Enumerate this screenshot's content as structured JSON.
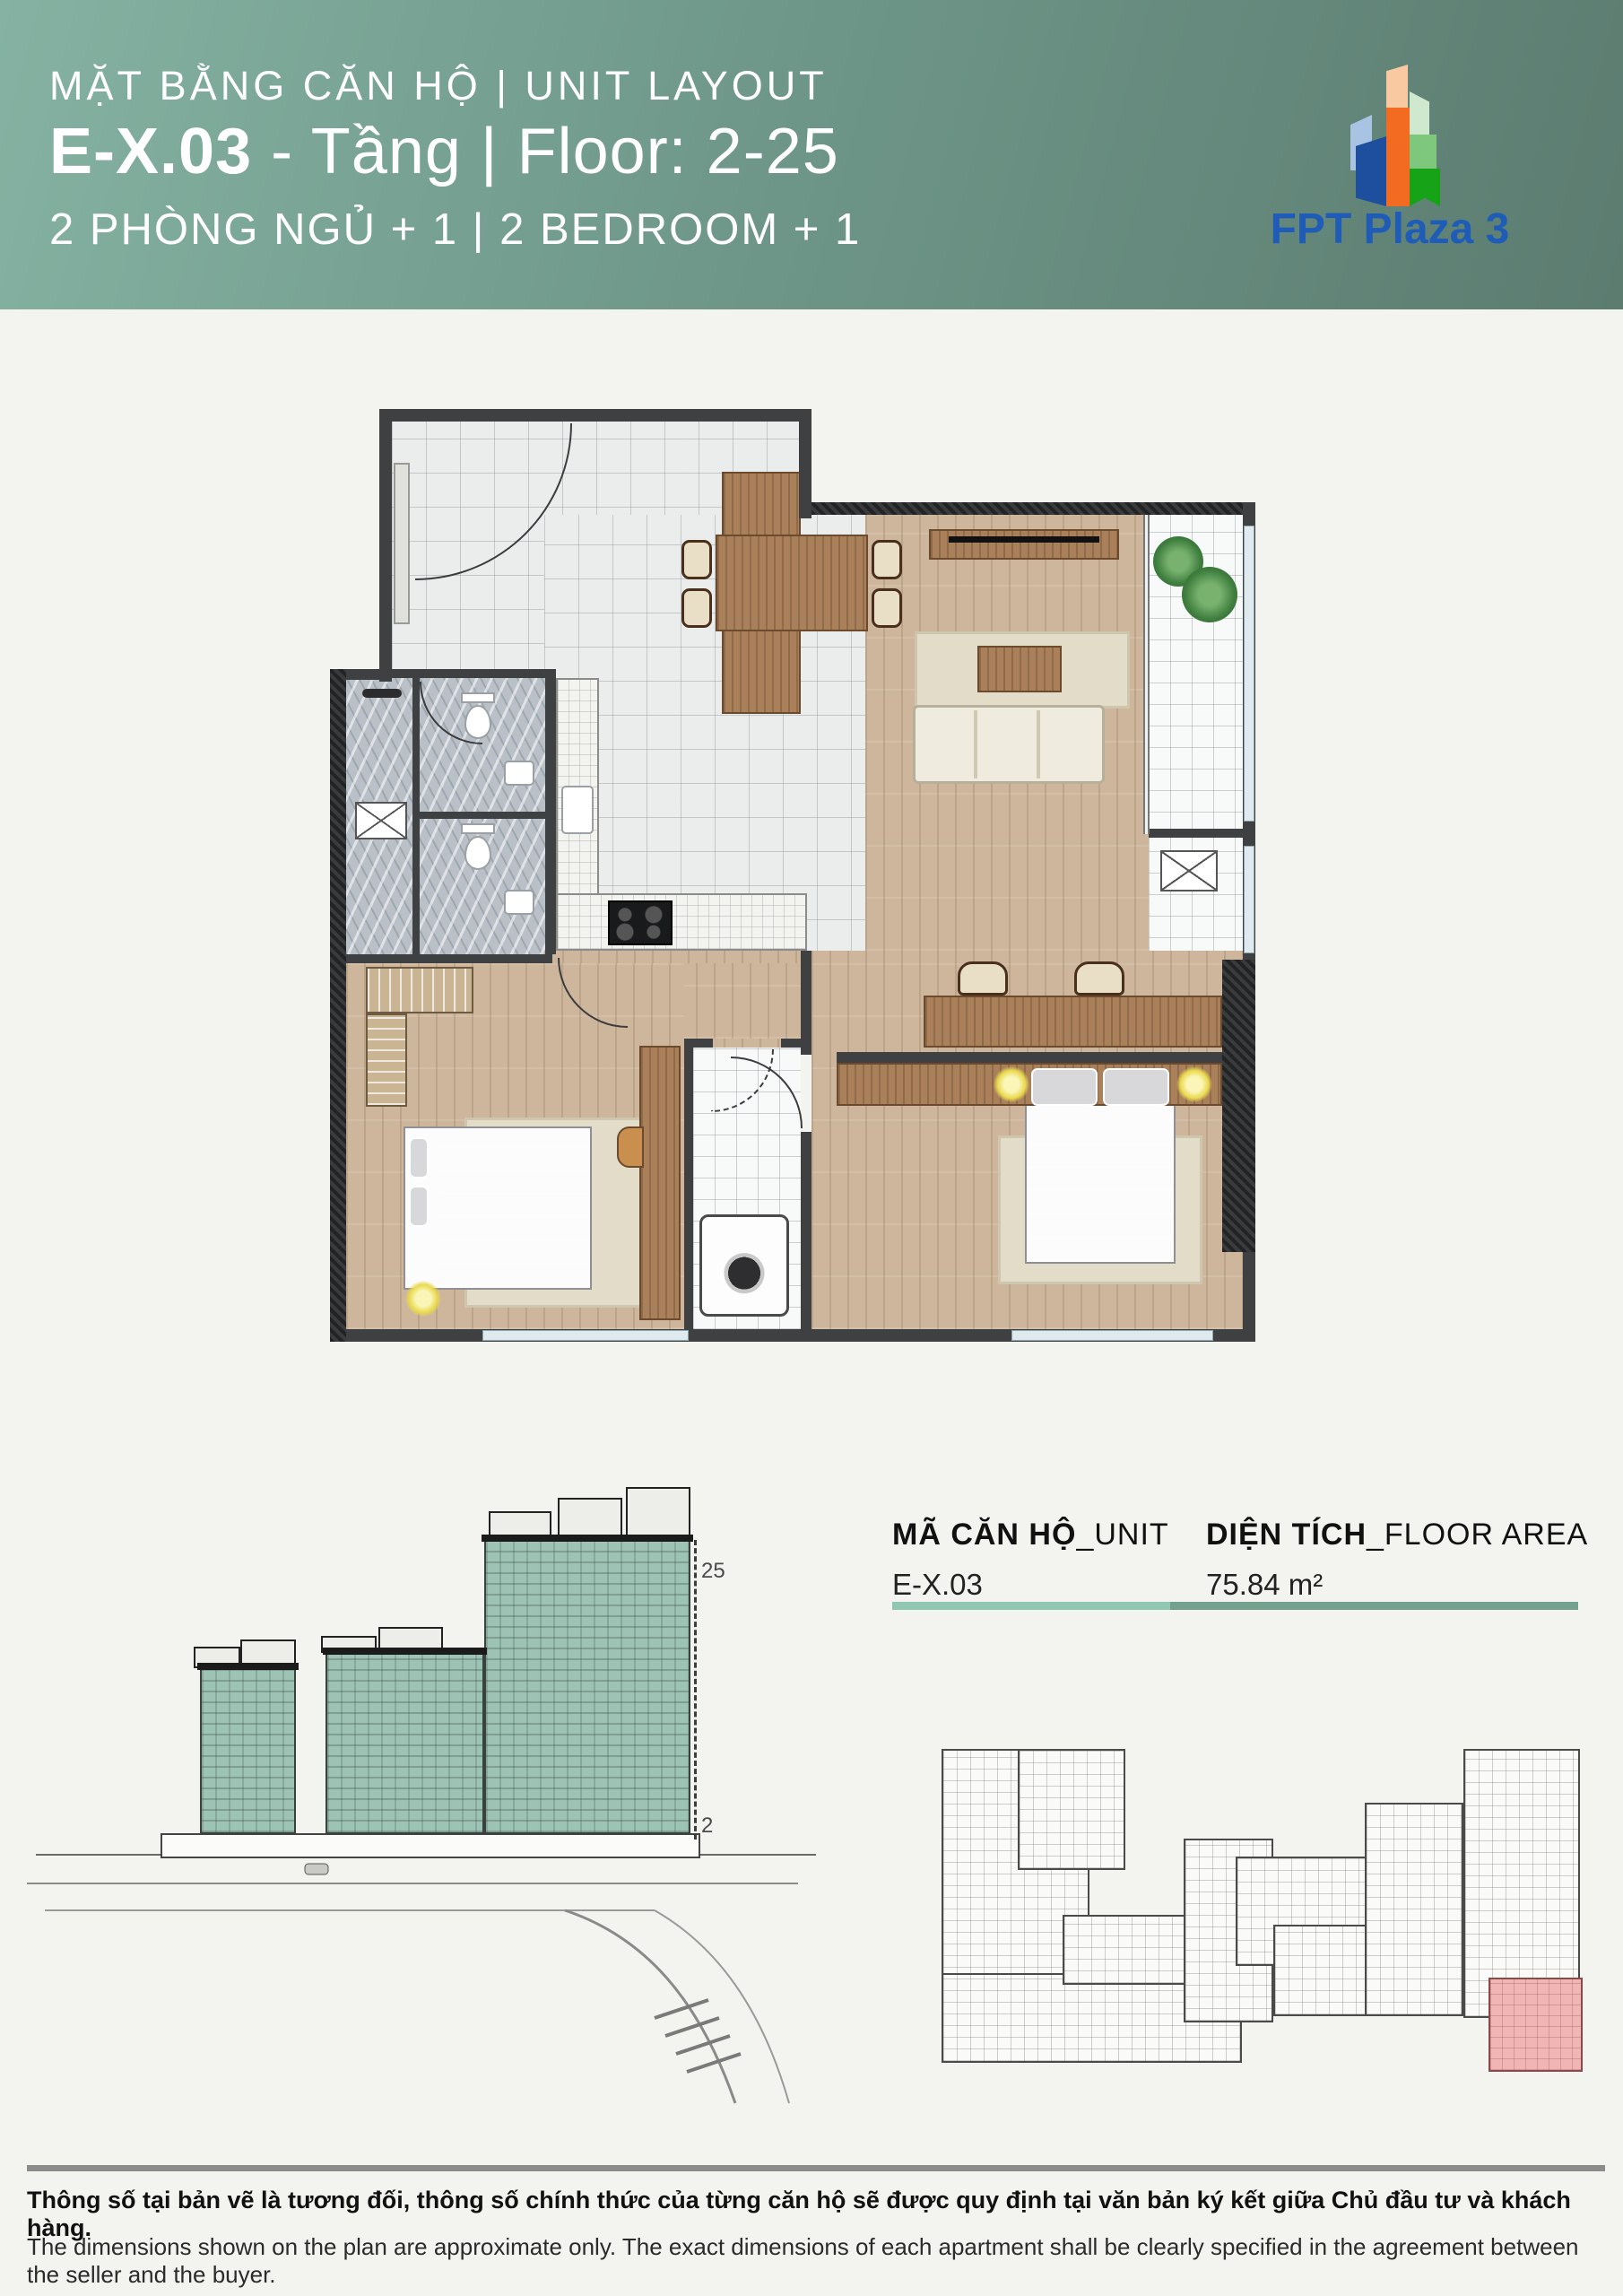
{
  "header": {
    "subtitle": "MẶT BẰNG CĂN HỘ | UNIT LAYOUT",
    "unit_code": "E-X.03",
    "unit_suffix": " - Tầng | Floor: 2-25",
    "bedrooms": "2 PHÒNG NGỦ + 1 | 2 BEDROOM + 1",
    "colors": {
      "gradient_left": "#85b2a2",
      "gradient_right": "#5c7c70"
    }
  },
  "logo": {
    "text": "FPT Plaza 3",
    "color": "#1f5cb8"
  },
  "info": {
    "unit_label_vn": "MÃ CĂN HỘ",
    "unit_label_en": "_UNIT",
    "unit_value": "E-X.03",
    "area_label_vn": "DIỆN TÍCH",
    "area_label_en": "_FLOOR AREA",
    "area_value": "75.84 m²",
    "bar_color_left": "#8fc7b3",
    "bar_color_right": "#74a18f"
  },
  "building": {
    "floor_top_label": "25",
    "floor_bottom_label": "2",
    "highlight_color": "#9dc3b4"
  },
  "keyplan": {
    "highlight_color": "#f2b5b5"
  },
  "footer": {
    "line_vn": "Thông số tại bản vẽ là tương đối, thông số chính thức của từng căn hộ sẽ được quy định tại văn bản ký kết giữa Chủ đầu tư và khách hàng.",
    "line_en": "The dimensions shown on the plan are approximate only. The exact dimensions of each apartment shall be clearly specified in the agreement between the seller and the buyer."
  }
}
